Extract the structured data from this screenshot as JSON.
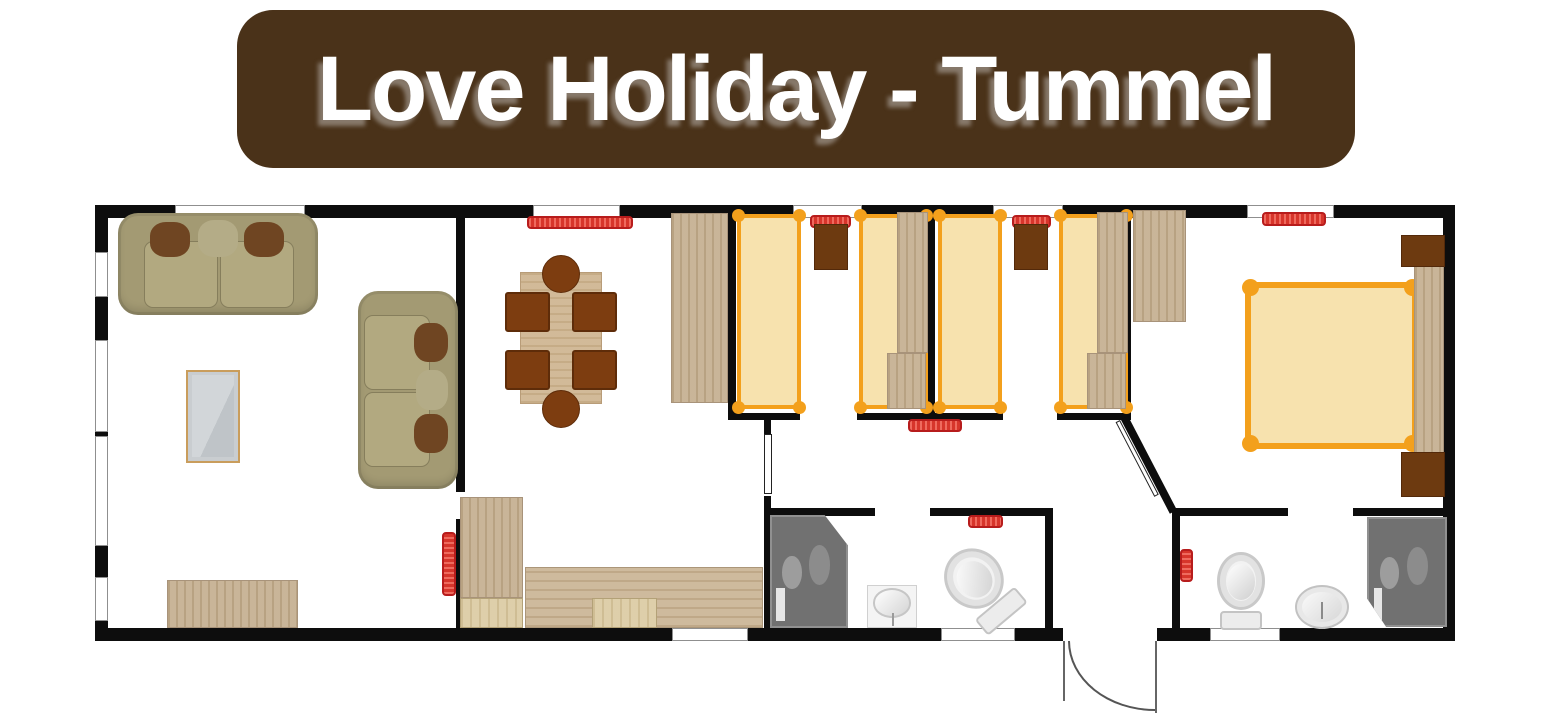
{
  "banner": {
    "title": "Love Holiday - Tummel",
    "bg": "#4a3219",
    "text_color": "#ffffff"
  },
  "palette": {
    "banner_bg": "#4a3219",
    "wall": "#0d0d0d",
    "window_frame": "#8f8f8f",
    "bed_frame": "#f3a01c",
    "bed_fill": "#f7e2ae",
    "radiator": "#d7352b",
    "radiator_border": "#b71c1c",
    "wood": "#c3ad8d",
    "wood_light": "#d9c89e",
    "counter": "#c9b292",
    "sofa": "#a39a73",
    "sofa_seat": "#b2a980",
    "cushion": "#6f4522",
    "cushion_dark": "#6d3a10",
    "chair": "#7d3d10",
    "shower": "#717171"
  },
  "floorplan": {
    "groups": [
      {
        "room": "structure",
        "items": [
          {
            "name": "outer-wall-top",
            "type": "wall",
            "rect": [
              95,
              205,
              1360,
              13
            ]
          },
          {
            "name": "outer-wall-bottom",
            "type": "wall",
            "rect": [
              95,
              628,
              1360,
              13
            ]
          },
          {
            "name": "outer-wall-left",
            "type": "wall",
            "rect": [
              95,
              205,
              13,
              436
            ]
          },
          {
            "name": "outer-wall-right",
            "type": "wall",
            "rect": [
              1443,
              205,
              12,
              436
            ]
          },
          {
            "name": "wall-living-dining-upper",
            "type": "wall",
            "rect": [
              456,
              205,
              9,
              287
            ]
          },
          {
            "name": "wall-living-dining-lower",
            "type": "wall",
            "rect": [
              456,
              519,
              9,
              122
            ]
          },
          {
            "name": "wall-dining-bedroom1",
            "type": "wall",
            "rect": [
              728,
              205,
              8,
              215
            ]
          },
          {
            "name": "wall-bedroom1-bedroom2",
            "type": "wall",
            "rect": [
              928,
              205,
              7,
              215
            ]
          },
          {
            "name": "wall-bedroom2-master",
            "type": "wall",
            "rect": [
              1123,
              205,
              8,
              213
            ]
          },
          {
            "name": "wall-bedroom1-front-left",
            "type": "wall",
            "rect": [
              728,
              413,
              72,
              7
            ]
          },
          {
            "name": "wall-bedroom1-front-right",
            "type": "wall",
            "rect": [
              857,
              413,
              71,
              7
            ]
          },
          {
            "name": "wall-bedroom2-front-left",
            "type": "wall",
            "rect": [
              934,
              413,
              69,
              7
            ]
          },
          {
            "name": "wall-bedroom2-front-right",
            "type": "wall",
            "rect": [
              1057,
              413,
              74,
              7
            ]
          },
          {
            "name": "wall-kitchen-corridor-upper",
            "type": "wall",
            "rect": [
              764,
              420,
              7,
              14
            ]
          },
          {
            "name": "wall-kitchen-corridor-lower",
            "type": "wall",
            "rect": [
              764,
              496,
              7,
              145
            ]
          },
          {
            "name": "wall-shower-room-top-left",
            "type": "wall",
            "rect": [
              764,
              508,
              111,
              8
            ]
          },
          {
            "name": "wall-shower-room-top-right",
            "type": "wall",
            "rect": [
              930,
              508,
              122,
              8
            ]
          },
          {
            "name": "wall-shower-room-hall",
            "type": "wall",
            "rect": [
              1045,
              508,
              8,
              133
            ]
          },
          {
            "name": "wall-hall-ensuite",
            "type": "wall",
            "rect": [
              1172,
              508,
              8,
              133
            ]
          },
          {
            "name": "wall-ensuite-top-left",
            "type": "wall",
            "rect": [
              1180,
              508,
              108,
              8
            ]
          },
          {
            "name": "wall-ensuite-top-right",
            "type": "wall",
            "rect": [
              1353,
              508,
              102,
              8
            ]
          },
          {
            "name": "wall-master-diagonal",
            "type": "wall",
            "rect": [
              1128,
              416,
              106,
              8
            ],
            "rot": 62.5,
            "origin": "0 0"
          },
          {
            "name": "door-master-diagonal",
            "type": "door-leaf",
            "rect": [
              1120,
              420,
              84,
              5
            ],
            "rot": 62.5,
            "origin": "0 0"
          },
          {
            "name": "window-top-1",
            "type": "window",
            "rect": [
              175,
              205,
              130,
              13
            ]
          },
          {
            "name": "window-top-2",
            "type": "window",
            "rect": [
              533,
              205,
              87,
              13
            ]
          },
          {
            "name": "window-top-3",
            "type": "window",
            "rect": [
              793,
              205,
              69,
              13
            ]
          },
          {
            "name": "window-top-4",
            "type": "window",
            "rect": [
              993,
              205,
              70,
              13
            ]
          },
          {
            "name": "window-top-5",
            "type": "window",
            "rect": [
              1247,
              205,
              87,
              13
            ]
          },
          {
            "name": "window-left-1",
            "type": "window",
            "rect": [
              95,
              252,
              13,
              45
            ]
          },
          {
            "name": "window-left-2",
            "type": "window",
            "rect": [
              95,
              340,
              13,
              92
            ]
          },
          {
            "name": "window-left-3",
            "type": "window",
            "rect": [
              95,
              436,
              13,
              110
            ]
          },
          {
            "name": "window-left-4",
            "type": "window",
            "rect": [
              95,
              577,
              13,
              44
            ]
          },
          {
            "name": "window-bottom-1",
            "type": "window",
            "rect": [
              672,
              628,
              76,
              13
            ]
          },
          {
            "name": "window-bottom-2",
            "type": "window",
            "rect": [
              941,
              628,
              74,
              13
            ]
          },
          {
            "name": "window-bottom-3",
            "type": "window",
            "rect": [
              1210,
              628,
              70,
              13
            ]
          }
        ]
      },
      {
        "room": "living-room",
        "items": [
          {
            "name": "large-sofa",
            "type": "sofa-h",
            "rect": [
              118,
              213,
              200,
              102
            ]
          },
          {
            "name": "small-sofa",
            "type": "sofa-v",
            "rect": [
              358,
              291,
              100,
              198
            ]
          },
          {
            "name": "tv-unit",
            "type": "tv-unit",
            "rect": [
              186,
              370,
              54,
              93
            ]
          },
          {
            "name": "sideboard",
            "type": "wood",
            "rect": [
              167,
              580,
              131,
              48
            ]
          },
          {
            "name": "radiator",
            "type": "rad-v",
            "rect": [
              442,
              532,
              14,
              64
            ]
          }
        ]
      },
      {
        "room": "dining-area",
        "items": [
          {
            "name": "radiator",
            "type": "rad-h",
            "rect": [
              527,
              216,
              106,
              13
            ]
          },
          {
            "name": "tall-cabinet",
            "type": "wood",
            "rect": [
              671,
              213,
              57,
              190
            ]
          },
          {
            "name": "dining-table",
            "type": "table",
            "rect": [
              520,
              272,
              82,
              132
            ]
          },
          {
            "name": "stool-top",
            "type": "stool",
            "rect": [
              542,
              255,
              38,
              38
            ]
          },
          {
            "name": "stool-bottom",
            "type": "stool",
            "rect": [
              542,
              390,
              38,
              38
            ]
          },
          {
            "name": "chair-1",
            "type": "chair",
            "rect": [
              505,
              292,
              45,
              40
            ]
          },
          {
            "name": "chair-2",
            "type": "chair",
            "rect": [
              572,
              292,
              45,
              40
            ]
          },
          {
            "name": "chair-3",
            "type": "chair",
            "rect": [
              505,
              350,
              45,
              40
            ]
          },
          {
            "name": "chair-4",
            "type": "chair",
            "rect": [
              572,
              350,
              45,
              40
            ]
          }
        ]
      },
      {
        "room": "kitchen",
        "items": [
          {
            "name": "tall-unit",
            "type": "wood",
            "rect": [
              460,
              497,
              63,
              101
            ]
          },
          {
            "name": "base-unit-1",
            "type": "wood-light",
            "rect": [
              460,
              598,
              63,
              30
            ]
          },
          {
            "name": "worktop",
            "type": "counter",
            "rect": [
              525,
              567,
              238,
              61
            ]
          },
          {
            "name": "base-unit-2",
            "type": "wood-light",
            "rect": [
              592,
              598,
              65,
              30
            ]
          }
        ]
      },
      {
        "room": "bedroom-1",
        "items": [
          {
            "name": "bed-left",
            "type": "bed",
            "rect": [
              737,
              214,
              64,
              195
            ]
          },
          {
            "name": "radiator",
            "type": "rad-h",
            "rect": [
              810,
              215,
              41,
              13
            ]
          },
          {
            "name": "bedside-unit",
            "type": "brown-unit",
            "rect": [
              814,
              224,
              34,
              46
            ]
          },
          {
            "name": "bed-right",
            "type": "bed",
            "rect": [
              859,
              214,
              69,
              195
            ]
          },
          {
            "name": "wardrobe-upper",
            "type": "wood",
            "rect": [
              897,
              212,
              31,
              141
            ]
          },
          {
            "name": "wardrobe-lower",
            "type": "wood",
            "rect": [
              887,
              353,
              39,
              56
            ]
          }
        ]
      },
      {
        "room": "bedroom-2",
        "items": [
          {
            "name": "bed-left",
            "type": "bed",
            "rect": [
              938,
              214,
              64,
              195
            ]
          },
          {
            "name": "radiator",
            "type": "rad-h",
            "rect": [
              1012,
              215,
              39,
              13
            ]
          },
          {
            "name": "bedside-unit",
            "type": "brown-unit",
            "rect": [
              1014,
              224,
              34,
              46
            ]
          },
          {
            "name": "bed-right",
            "type": "bed",
            "rect": [
              1059,
              214,
              69,
              195
            ]
          },
          {
            "name": "wardrobe-upper",
            "type": "wood",
            "rect": [
              1097,
              212,
              31,
              141
            ]
          },
          {
            "name": "wardrobe-lower",
            "type": "wood",
            "rect": [
              1087,
              353,
              39,
              56
            ]
          }
        ]
      },
      {
        "room": "corridor",
        "items": [
          {
            "name": "radiator",
            "type": "rad-h",
            "rect": [
              908,
              419,
              54,
              13
            ]
          }
        ]
      },
      {
        "room": "master-bedroom",
        "items": [
          {
            "name": "wardrobe",
            "type": "wood",
            "rect": [
              1133,
              210,
              53,
              112
            ]
          },
          {
            "name": "radiator",
            "type": "rad-h",
            "rect": [
              1262,
              212,
              64,
              14
            ]
          },
          {
            "name": "double-bed",
            "type": "bed-double",
            "rect": [
              1245,
              282,
              173,
              167
            ]
          },
          {
            "name": "headboard",
            "type": "wood",
            "rect": [
              1414,
              266,
              30,
              197
            ]
          },
          {
            "name": "nightstand-top",
            "type": "brown-unit",
            "rect": [
              1401,
              235,
              44,
              32
            ]
          },
          {
            "name": "nightstand-bottom",
            "type": "brown-unit",
            "rect": [
              1401,
              452,
              44,
              45
            ]
          }
        ]
      },
      {
        "room": "shower-room",
        "items": [
          {
            "name": "door",
            "type": "door-leaf",
            "rect": [
              764,
              434,
              8,
              60
            ]
          },
          {
            "name": "shower",
            "type": "shower",
            "cut": "tr",
            "rect": [
              770,
              515,
              78,
              113
            ]
          },
          {
            "name": "radiator",
            "type": "rad-h",
            "rect": [
              968,
              515,
              35,
              13
            ]
          },
          {
            "name": "sink",
            "type": "sink-square",
            "rect": [
              867,
              585,
              50,
              43
            ]
          },
          {
            "name": "toilet",
            "type": "toilet",
            "rect": [
              952,
              545,
              58,
              84
            ],
            "rot": -40
          }
        ]
      },
      {
        "room": "hallway",
        "items": [
          {
            "name": "entrance-opening",
            "type": "opening",
            "rect": [
              1063,
              628,
              94,
              13
            ]
          },
          {
            "name": "entrance-door-arc",
            "type": "arc",
            "rect": [
              1068,
              641,
              87,
              70
            ]
          },
          {
            "name": "entrance-door-line-right",
            "type": "vline",
            "rect": [
              1155,
              641,
              2,
              72
            ]
          },
          {
            "name": "entrance-door-line-left",
            "type": "vline",
            "rect": [
              1063,
              641,
              2,
              60
            ]
          }
        ]
      },
      {
        "room": "ensuite",
        "items": [
          {
            "name": "radiator",
            "type": "rad-v",
            "rect": [
              1180,
              549,
              13,
              33
            ]
          },
          {
            "name": "toilet",
            "type": "toilet",
            "rect": [
              1217,
              552,
              48,
              78
            ]
          },
          {
            "name": "sink",
            "type": "sink-round",
            "rect": [
              1295,
              585,
              54,
              44
            ]
          },
          {
            "name": "shower",
            "type": "shower",
            "cut": "bl",
            "rect": [
              1367,
              517,
              80,
              110
            ]
          }
        ]
      }
    ]
  }
}
